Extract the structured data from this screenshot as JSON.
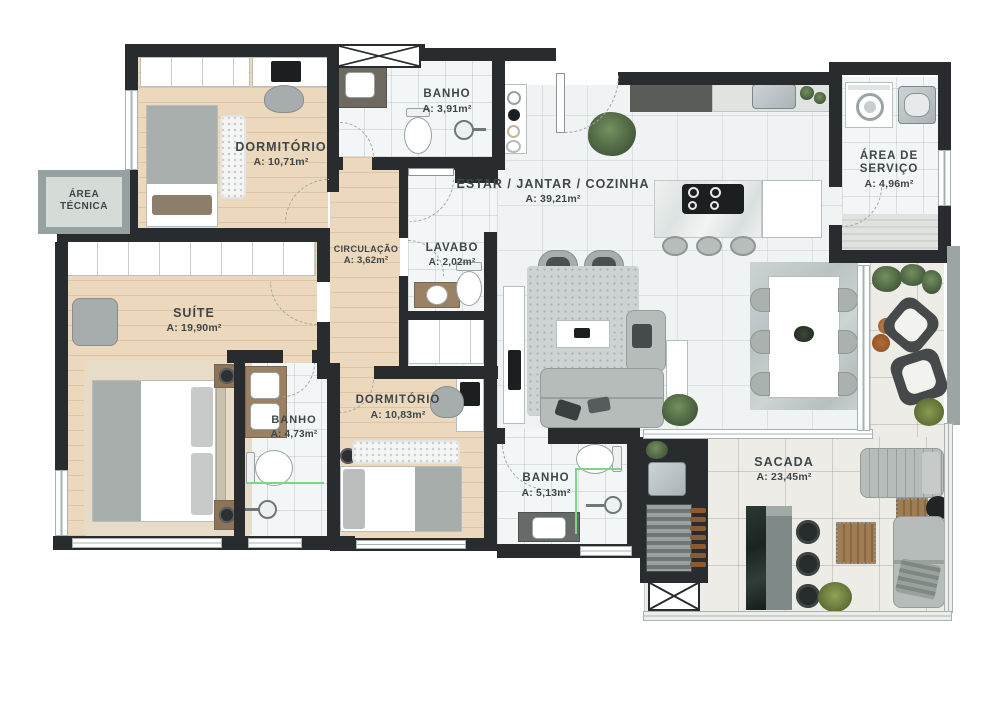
{
  "rooms": [
    {
      "name": "DORMITÓRIO",
      "area": "A: 10,71m²"
    },
    {
      "name": "BANHO",
      "area": "A: 3,91m²"
    },
    {
      "name": "ESTAR / JANTAR / COZINHA",
      "area": "A: 39,21m²"
    },
    {
      "name": "ÁREA DE SERVIÇO",
      "area": "A: 4,96m²"
    },
    {
      "name": "ÁREA TÉCNICA",
      "area": ""
    },
    {
      "name": "CIRCULAÇÃO",
      "area": "A: 3,62m²"
    },
    {
      "name": "LAVABO",
      "area": "A: 2,02m²"
    },
    {
      "name": "SUÍTE",
      "area": "A: 19,90m²"
    },
    {
      "name": "BANHO",
      "area": "A: 4,73m²"
    },
    {
      "name": "DORMITÓRIO",
      "area": "A: 10,83m²"
    },
    {
      "name": "BANHO",
      "area": "A: 5,13m²"
    },
    {
      "name": "SACADA",
      "area": "A: 23,45m²"
    }
  ],
  "colors": {
    "wall": "#282c2e",
    "wood_floor": "#ecd9bd",
    "tile_floor": "#f3f6f6",
    "balcony_floor": "#edece6",
    "label_text": "#3e464a",
    "glass_partition_accent": "#7ed487",
    "plant_green": "#5c7553",
    "counter_wood": "#9b8164"
  }
}
